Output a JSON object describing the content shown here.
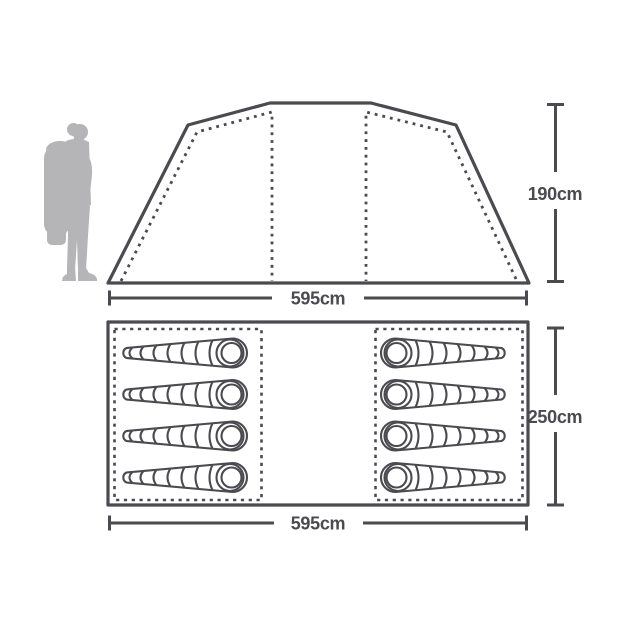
{
  "diagram": {
    "subject": "tent-dimensions-diagram",
    "line_color": "#4a4a4f",
    "silhouette_color": "#b5b5b7",
    "background_color": "#ffffff",
    "side_view": {
      "width_label": "595cm",
      "height_label": "190cm"
    },
    "floor_plan": {
      "width_label": "595cm",
      "depth_label": "250cm",
      "sleeping_bag_count": 8,
      "compartments": [
        {
          "side": "left",
          "bags": 4,
          "head_end": "right"
        },
        {
          "side": "right",
          "bags": 4,
          "head_end": "left"
        }
      ]
    }
  }
}
